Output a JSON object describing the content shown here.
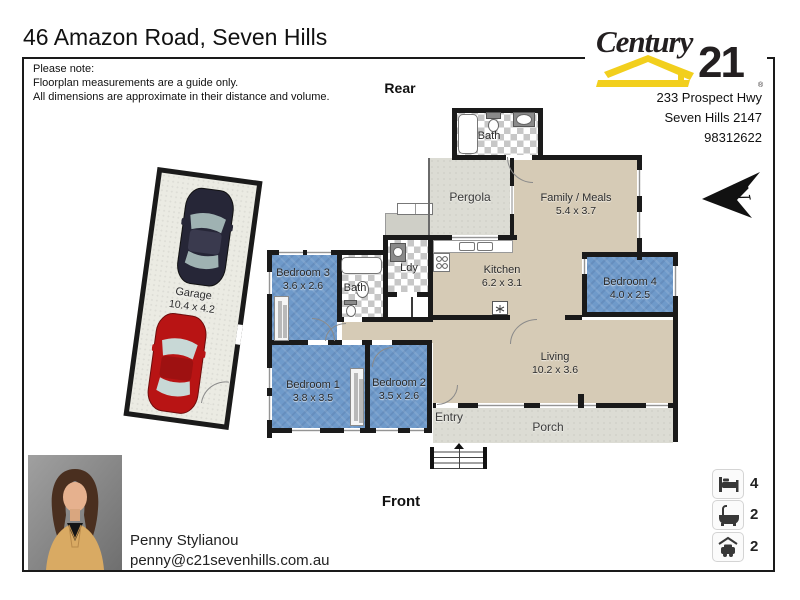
{
  "title": "46 Amazon Road, Seven Hills",
  "note": {
    "l1": "Please note:",
    "l2": "Floorplan measurements are a guide only.",
    "l3": "All dimensions are approximate in their distance and volume."
  },
  "brand": {
    "word": "Century",
    "number": "21",
    "registered": "®",
    "address1": "233 Prospect Hwy",
    "address2": "Seven Hills 2147",
    "phone": "98312622"
  },
  "orientation": {
    "rear": "Rear",
    "front": "Front",
    "north": "N"
  },
  "rooms": {
    "bath_top": {
      "name": "Bath"
    },
    "pergola": {
      "name": "Pergola"
    },
    "family": {
      "name": "Family / Meals",
      "dims": "5.4 x 3.7"
    },
    "kitchen": {
      "name": "Kitchen",
      "dims": "6.2 x 3.1"
    },
    "bedroom4": {
      "name": "Bedroom 4",
      "dims": "4.0 x 2.5"
    },
    "bedroom3": {
      "name": "Bedroom 3",
      "dims": "3.6 x 2.6"
    },
    "bath": {
      "name": "Bath"
    },
    "laundry": {
      "name": "Ldy"
    },
    "bedroom1": {
      "name": "Bedroom 1",
      "dims": "3.8 x 3.5"
    },
    "bedroom2": {
      "name": "Bedroom 2",
      "dims": "3.5 x 2.6"
    },
    "living": {
      "name": "Living",
      "dims": "10.2 x 3.6"
    },
    "entry": {
      "name": "Entry"
    },
    "porch": {
      "name": "Porch"
    },
    "garage": {
      "name": "Garage",
      "dims": "10.4 x 4.2"
    }
  },
  "agent": {
    "name": "Penny Stylianou",
    "email": "penny@c21sevenhills.com.au"
  },
  "summary": {
    "beds": "4",
    "baths": "2",
    "cars": "2"
  },
  "colors": {
    "brand_yellow": "#f2cf1d",
    "brand_black": "#231f20",
    "wall": "#1a1a1a",
    "bedroom_blue": "#6f9aca",
    "floor_tan": "#d6cbb6",
    "outdoor_grey": "#dcdcd4"
  }
}
